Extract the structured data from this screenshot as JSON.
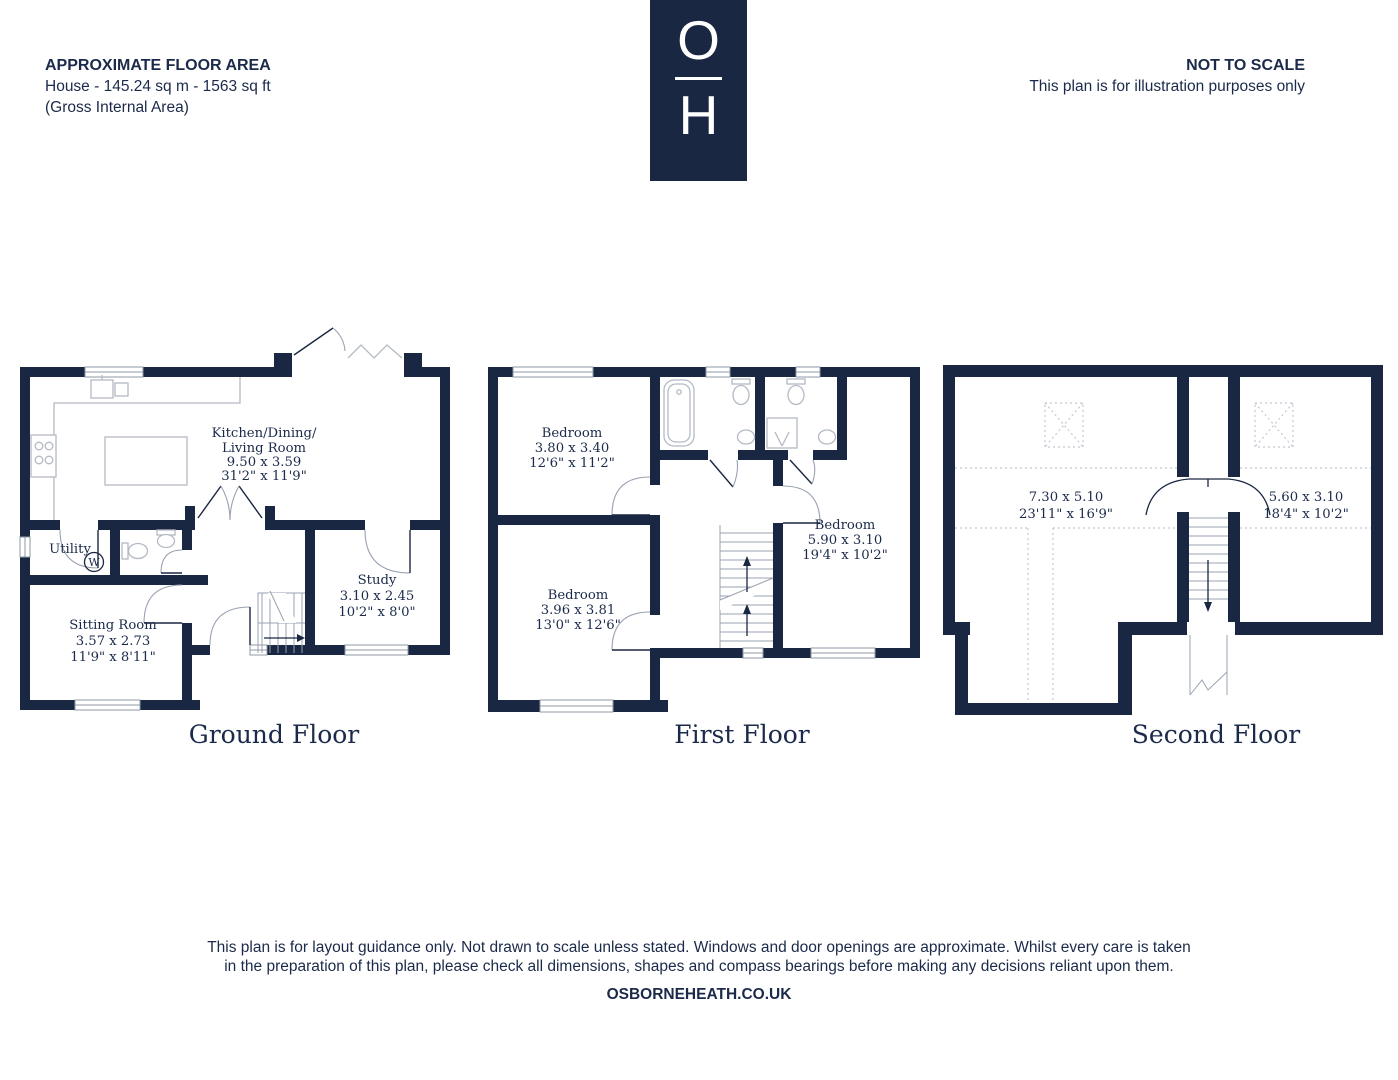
{
  "header": {
    "area_title": "APPROXIMATE FLOOR AREA",
    "area_detail": "House - 145.24 sq m - 1563 sq ft",
    "area_note": "(Gross Internal Area)",
    "scale_title": "NOT TO SCALE",
    "scale_note": "This plan is for illustration purposes only"
  },
  "logo": {
    "letter_top": "O",
    "letter_bottom": "H"
  },
  "floors": [
    {
      "title": "Ground Floor",
      "rooms": [
        {
          "name_line1": "Kitchen/Dining/",
          "name_line2": "Living Room",
          "metric": "9.50 x 3.59",
          "imperial": "31'2\" x 11'9\""
        },
        {
          "name_line1": "Utility"
        },
        {
          "name_line1": "Sitting Room",
          "metric": "3.57 x 2.73",
          "imperial": "11'9\" x 8'11\""
        },
        {
          "name_line1": "Study",
          "metric": "3.10 x 2.45",
          "imperial": "10'2\" x 8'0\""
        }
      ],
      "appliances": {
        "washing_machine": "W"
      }
    },
    {
      "title": "First Floor",
      "rooms": [
        {
          "name_line1": "Bedroom",
          "metric": "3.80 x 3.40",
          "imperial": "12'6\" x 11'2\""
        },
        {
          "name_line1": "Bedroom",
          "metric": "5.90 x 3.10",
          "imperial": "19'4\" x 10'2\""
        },
        {
          "name_line1": "Bedroom",
          "metric": "3.96 x 3.81",
          "imperial": "13'0\" x 12'6\""
        }
      ]
    },
    {
      "title": "Second Floor",
      "rooms": [
        {
          "metric": "7.30 x 5.10",
          "imperial": "23'11\" x 16'9\""
        },
        {
          "metric": "5.60 x 3.10",
          "imperial": "18'4\" x 10'2\""
        }
      ]
    }
  ],
  "footer": {
    "disclaimer_line1": "This plan is for layout guidance only. Not drawn to scale unless stated. Windows and door openings are approximate. Whilst every care is taken",
    "disclaimer_line2": "in the preparation of this plan, please check all dimensions, shapes and compass bearings before making any decisions reliant upon them.",
    "website": "OSBORNEHEATH.CO.UK"
  },
  "colors": {
    "wall_navy": "#1a2742",
    "text_navy": "#1b2a4a",
    "fixture_gray": "#b4bac4"
  }
}
